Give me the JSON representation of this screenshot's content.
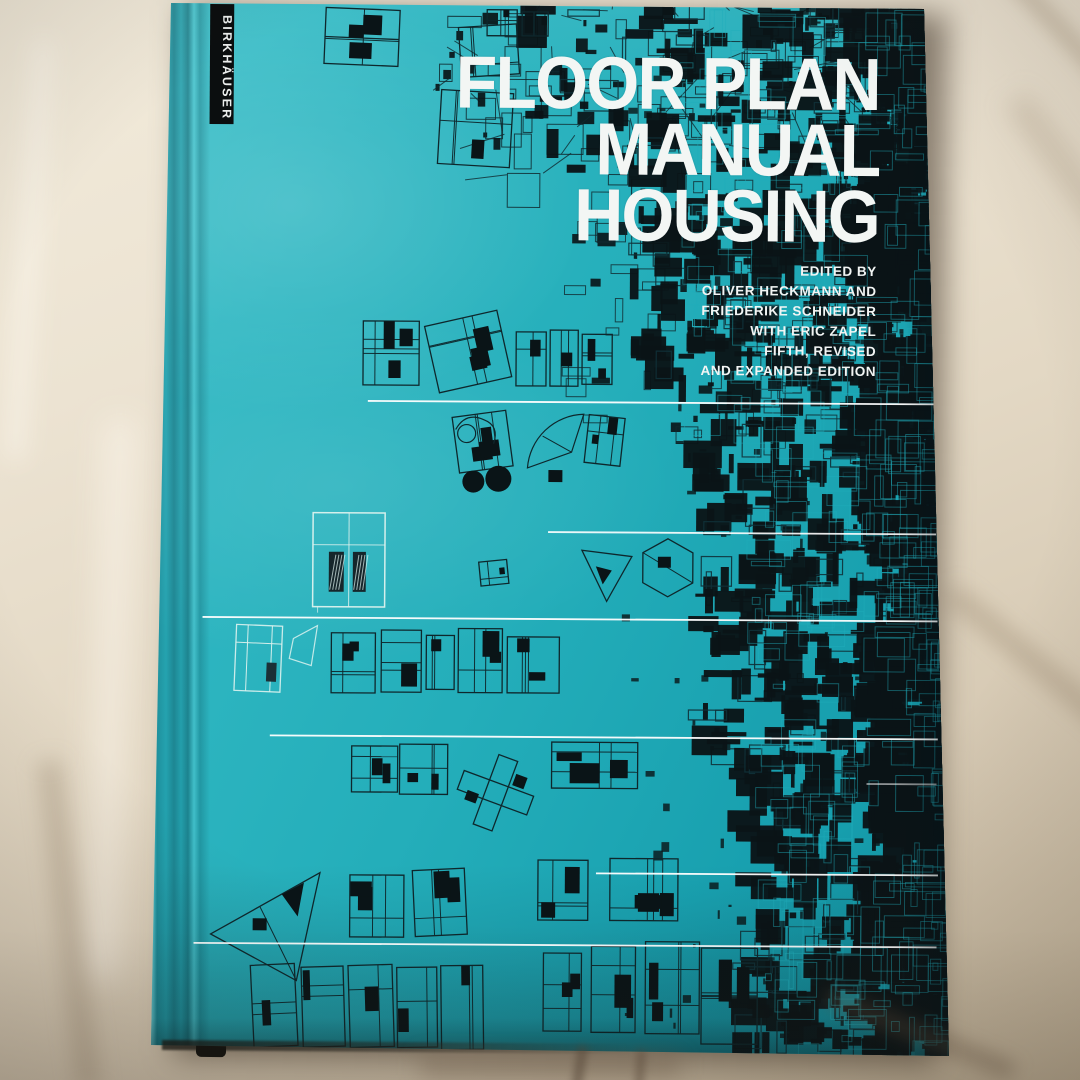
{
  "publisher": {
    "name": "BIRKHÄUSER"
  },
  "title": {
    "line1": "FLOOR PLAN",
    "line2": "MANUAL",
    "line3": "HOUSING"
  },
  "credits": {
    "lines": [
      "EDITED BY",
      "OLIVER HECKMANN AND",
      "FRIEDERIKE SCHNEIDER",
      "WITH ERIC ZAPEL",
      "FIFTH, REVISED",
      "AND EXPANDED EDITION"
    ]
  },
  "colors": {
    "cover_teal_light": "#49c6ce",
    "cover_teal": "#27b0bc",
    "cover_teal_dark": "#0e93a3",
    "pattern_ink": "#0a1417",
    "pattern_line": "#1fadbc",
    "plan_stroke": "#0e272c",
    "plan_light": "#ddf2ee",
    "rule_white": "#ffffff",
    "strip_black": "#0b0e0f",
    "text_white": "#f3f6f5",
    "fabric": "#e9e0cf"
  }
}
